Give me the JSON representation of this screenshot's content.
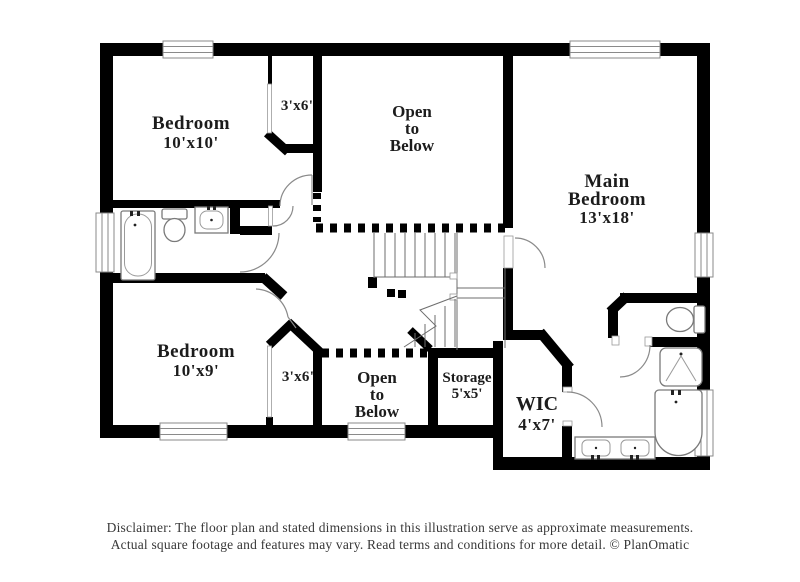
{
  "rooms": {
    "bedroom_top": {
      "name": "Bedroom",
      "dims": "10'x10'"
    },
    "closet_top": {
      "dims": "3'x6'"
    },
    "open_below_top": {
      "l1": "Open",
      "l2": "to",
      "l3": "Below"
    },
    "main_bedroom": {
      "l1": "Main",
      "l2": "Bedroom",
      "dims": "13'x18'"
    },
    "bedroom_bottom": {
      "name": "Bedroom",
      "dims": "10'x9'"
    },
    "closet_bottom": {
      "dims": "3'x6'"
    },
    "open_below_bottom": {
      "l1": "Open",
      "l2": "to",
      "l3": "Below"
    },
    "storage": {
      "name": "Storage",
      "dims": "5'x5'"
    },
    "wic": {
      "name": "WIC",
      "dims": "4'x7'"
    }
  },
  "footer": {
    "line1": "Disclaimer: The floor plan and stated dimensions in this illustration serve as approximate measurements.",
    "line2": "Actual square footage and features may vary. Read terms and conditions for more detail. © PlanOmatic"
  },
  "colors": {
    "wall": "#000000",
    "detail_line": "#6e6e6e",
    "fixture_line": "#8a8a8a",
    "label_text": "#1c1c1c",
    "footer_text": "#383838"
  }
}
